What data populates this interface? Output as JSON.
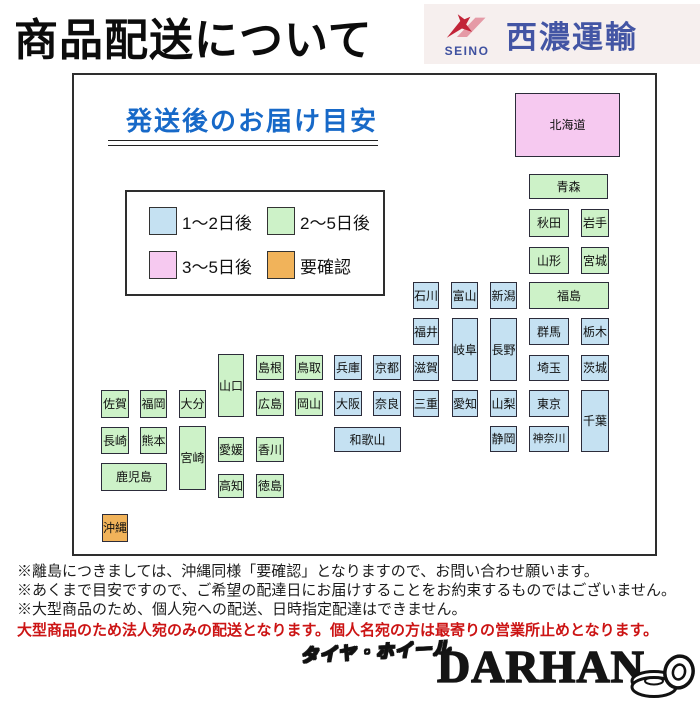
{
  "page": {
    "title": "商品配送について"
  },
  "logo": {
    "latin": "SEINO",
    "name": "西濃運輸",
    "bg": "#f6efee",
    "blue": "#4355a4",
    "red": "#c22438",
    "light_red": "#e59aa6"
  },
  "panel": {
    "heading": "発送後のお届け目安",
    "heading_color": "#1769c8"
  },
  "palette": {
    "blue": "#c5e1f2",
    "green": "#cdf2c8",
    "pink": "#f6c9f0",
    "orange": "#f1b35a"
  },
  "legend": {
    "items": [
      {
        "key": "blue",
        "label": "1〜2日後"
      },
      {
        "key": "green",
        "label": "2〜5日後"
      },
      {
        "key": "pink",
        "label": "3〜5日後"
      },
      {
        "key": "orange",
        "label": "要確認"
      }
    ]
  },
  "map": {
    "prefectures": [
      {
        "name": "北海道",
        "cat": "pink",
        "x": 441,
        "y": 18,
        "w": 105,
        "h": 64
      },
      {
        "name": "青森",
        "cat": "green",
        "x": 455,
        "y": 99,
        "w": 79,
        "h": 25
      },
      {
        "name": "秋田",
        "cat": "green",
        "x": 455,
        "y": 134,
        "w": 40,
        "h": 28
      },
      {
        "name": "岩手",
        "cat": "green",
        "x": 507,
        "y": 134,
        "w": 28,
        "h": 28
      },
      {
        "name": "山形",
        "cat": "green",
        "x": 455,
        "y": 172,
        "w": 40,
        "h": 27
      },
      {
        "name": "宮城",
        "cat": "green",
        "x": 507,
        "y": 172,
        "w": 28,
        "h": 27
      },
      {
        "name": "石川",
        "cat": "blue",
        "x": 339,
        "y": 207,
        "w": 26,
        "h": 27
      },
      {
        "name": "富山",
        "cat": "blue",
        "x": 377,
        "y": 207,
        "w": 27,
        "h": 27
      },
      {
        "name": "新潟",
        "cat": "blue",
        "x": 416,
        "y": 207,
        "w": 27,
        "h": 27
      },
      {
        "name": "福島",
        "cat": "green",
        "x": 455,
        "y": 207,
        "w": 80,
        "h": 27
      },
      {
        "name": "福井",
        "cat": "blue",
        "x": 339,
        "y": 243,
        "w": 26,
        "h": 27
      },
      {
        "name": "岐阜",
        "cat": "blue",
        "x": 378,
        "y": 243,
        "w": 26,
        "h": 63
      },
      {
        "name": "長野",
        "cat": "blue",
        "x": 416,
        "y": 243,
        "w": 27,
        "h": 63
      },
      {
        "name": "群馬",
        "cat": "blue",
        "x": 455,
        "y": 243,
        "w": 40,
        "h": 27
      },
      {
        "name": "栃木",
        "cat": "blue",
        "x": 507,
        "y": 243,
        "w": 28,
        "h": 27
      },
      {
        "name": "島根",
        "cat": "green",
        "x": 182,
        "y": 280,
        "w": 28,
        "h": 25
      },
      {
        "name": "鳥取",
        "cat": "green",
        "x": 221,
        "y": 280,
        "w": 28,
        "h": 25
      },
      {
        "name": "兵庫",
        "cat": "blue",
        "x": 260,
        "y": 280,
        "w": 28,
        "h": 25
      },
      {
        "name": "京都",
        "cat": "blue",
        "x": 299,
        "y": 280,
        "w": 28,
        "h": 25
      },
      {
        "name": "滋賀",
        "cat": "blue",
        "x": 339,
        "y": 280,
        "w": 26,
        "h": 26
      },
      {
        "name": "埼玉",
        "cat": "blue",
        "x": 455,
        "y": 280,
        "w": 40,
        "h": 26
      },
      {
        "name": "茨城",
        "cat": "blue",
        "x": 507,
        "y": 280,
        "w": 28,
        "h": 26
      },
      {
        "name": "山口",
        "cat": "green",
        "x": 144,
        "y": 279,
        "w": 26,
        "h": 63
      },
      {
        "name": "佐賀",
        "cat": "green",
        "x": 27,
        "y": 315,
        "w": 28,
        "h": 28
      },
      {
        "name": "福岡",
        "cat": "green",
        "x": 66,
        "y": 315,
        "w": 27,
        "h": 28
      },
      {
        "name": "大分",
        "cat": "green",
        "x": 105,
        "y": 315,
        "w": 27,
        "h": 28
      },
      {
        "name": "広島",
        "cat": "green",
        "x": 182,
        "y": 316,
        "w": 28,
        "h": 25
      },
      {
        "name": "岡山",
        "cat": "green",
        "x": 221,
        "y": 316,
        "w": 28,
        "h": 25
      },
      {
        "name": "大阪",
        "cat": "blue",
        "x": 260,
        "y": 316,
        "w": 28,
        "h": 25
      },
      {
        "name": "奈良",
        "cat": "blue",
        "x": 299,
        "y": 316,
        "w": 28,
        "h": 25
      },
      {
        "name": "三重",
        "cat": "blue",
        "x": 339,
        "y": 315,
        "w": 26,
        "h": 27
      },
      {
        "name": "愛知",
        "cat": "blue",
        "x": 378,
        "y": 315,
        "w": 26,
        "h": 27
      },
      {
        "name": "山梨",
        "cat": "blue",
        "x": 416,
        "y": 315,
        "w": 27,
        "h": 27
      },
      {
        "name": "東京",
        "cat": "blue",
        "x": 455,
        "y": 315,
        "w": 40,
        "h": 27
      },
      {
        "name": "千葉",
        "cat": "blue",
        "x": 507,
        "y": 315,
        "w": 28,
        "h": 62
      },
      {
        "name": "長崎",
        "cat": "green",
        "x": 27,
        "y": 352,
        "w": 28,
        "h": 27
      },
      {
        "name": "熊本",
        "cat": "green",
        "x": 66,
        "y": 352,
        "w": 27,
        "h": 27
      },
      {
        "name": "宮崎",
        "cat": "green",
        "x": 105,
        "y": 351,
        "w": 27,
        "h": 64
      },
      {
        "name": "愛媛",
        "cat": "green",
        "x": 144,
        "y": 362,
        "w": 26,
        "h": 25
      },
      {
        "name": "香川",
        "cat": "green",
        "x": 182,
        "y": 362,
        "w": 28,
        "h": 25
      },
      {
        "name": "和歌山",
        "cat": "blue",
        "x": 260,
        "y": 352,
        "w": 67,
        "h": 25
      },
      {
        "name": "静岡",
        "cat": "blue",
        "x": 416,
        "y": 351,
        "w": 27,
        "h": 26
      },
      {
        "name": "神奈川",
        "cat": "blue",
        "x": 455,
        "y": 351,
        "w": 40,
        "h": 26
      },
      {
        "name": "鹿児島",
        "cat": "green",
        "x": 27,
        "y": 388,
        "w": 66,
        "h": 28
      },
      {
        "name": "高知",
        "cat": "green",
        "x": 144,
        "y": 399,
        "w": 26,
        "h": 24
      },
      {
        "name": "徳島",
        "cat": "green",
        "x": 182,
        "y": 399,
        "w": 28,
        "h": 24
      },
      {
        "name": "沖縄",
        "cat": "orange",
        "x": 28,
        "y": 439,
        "w": 26,
        "h": 28
      }
    ]
  },
  "notes": [
    {
      "text": "※離島につきましては、沖縄同様「要確認」となりますので、お問い合わせ願います。",
      "emphasis": false
    },
    {
      "text": "※あくまで目安ですので、ご希望の配達日にお届けすることをお約束するものではございません。",
      "emphasis": false
    },
    {
      "text": "※大型商品のため、個人宛への配送、日時指定配達はできません。",
      "emphasis": false
    },
    {
      "text": "大型商品のため法人宛のみの配送となります。個人名宛の方は最寄りの営業所止めとなります。",
      "emphasis": true
    }
  ],
  "footer": {
    "shop_type": "タイヤ・ホイール",
    "shop_name": "DARHAN"
  }
}
